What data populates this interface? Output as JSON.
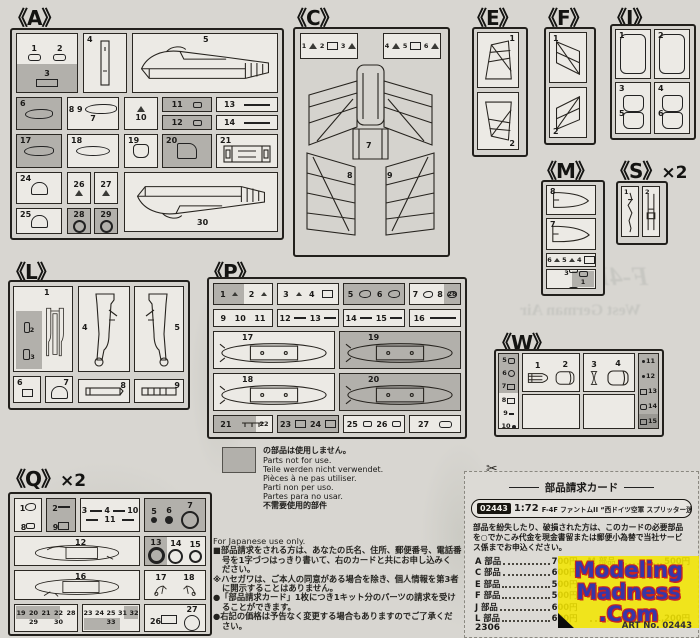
{
  "page": {
    "paper": "#d8d6d1",
    "box_bg": "#eceae5",
    "shaded": "#b2b0ab",
    "border": "#22201c"
  },
  "sprues": {
    "A": {
      "label": "《A》",
      "n": {
        "1": "1",
        "2": "2",
        "3": "3",
        "4": "4",
        "5": "5",
        "6": "6",
        "7": "7",
        "8": "8",
        "9": "9",
        "10": "10",
        "11": "11",
        "12": "12",
        "13": "13",
        "14": "14",
        "17": "17",
        "18": "18",
        "19": "19",
        "20": "20",
        "21": "21",
        "24": "24",
        "25": "25",
        "26": "26",
        "27": "27",
        "28": "28",
        "29": "29",
        "30": "30"
      }
    },
    "C": {
      "label": "《C》",
      "n": {
        "1": "1",
        "2": "2",
        "3": "3",
        "4": "4",
        "5": "5",
        "6": "6",
        "7": "7",
        "8": "8",
        "9": "9"
      }
    },
    "E": {
      "label": "《E》",
      "n": {
        "1": "1",
        "2": "2"
      }
    },
    "F": {
      "label": "《F》",
      "n": {
        "1": "1",
        "2": "2"
      }
    },
    "J": {
      "label": "《J》",
      "n": {
        "1": "1",
        "2": "2",
        "3": "3",
        "4": "4",
        "5": "5",
        "6": "6"
      }
    },
    "M": {
      "label": "《M》",
      "n": {
        "1": "1",
        "2": "2",
        "3": "3",
        "4": "4",
        "5": "5",
        "6": "6",
        "7": "7",
        "8": "8"
      }
    },
    "S": {
      "label": "《S》",
      "mult": "×2",
      "n": {
        "1": "1",
        "2": "2"
      }
    },
    "W": {
      "label": "《W》",
      "n": {
        "1": "1",
        "2": "2",
        "3": "3",
        "4": "4",
        "5": "5",
        "6": "6",
        "7": "7",
        "8": "8",
        "9": "9",
        "10": "10",
        "11": "11",
        "12": "12",
        "13": "13",
        "14": "14",
        "15": "15"
      }
    },
    "L": {
      "label": "《L》",
      "n": {
        "1": "1",
        "2": "2",
        "3": "3",
        "4": "4",
        "5": "5",
        "6": "6",
        "7": "7",
        "8": "8",
        "9": "9"
      }
    },
    "P": {
      "label": "《P》",
      "n": {
        "1": "1",
        "2": "2",
        "3": "3",
        "4": "4",
        "5": "5",
        "6": "6",
        "7": "7",
        "8": "8",
        "9": "9",
        "10": "10",
        "11": "11",
        "12": "12",
        "13": "13",
        "14": "14",
        "15": "15",
        "16": "16",
        "17": "17",
        "18": "18",
        "19": "19",
        "20": "20",
        "21": "21",
        "22": "22",
        "23": "23",
        "24": "24",
        "25": "25",
        "26": "26",
        "27": "27",
        "28": "28"
      }
    },
    "Q": {
      "label": "《Q》",
      "mult": "×2",
      "n": {
        "1": "1",
        "2": "2",
        "3": "3",
        "4": "4",
        "5": "5",
        "6": "6",
        "7": "7",
        "8": "8",
        "9": "9",
        "10": "10",
        "11": "11",
        "12": "12",
        "13": "13",
        "14": "14",
        "15": "15",
        "16": "16",
        "17": "17",
        "18": "18",
        "19": "19",
        "20": "20",
        "21": "21",
        "22": "22",
        "23": "23",
        "24": "24",
        "25": "25",
        "26": "26",
        "27": "27",
        "28": "28",
        "29": "29",
        "30": "30",
        "31": "31",
        "32": "32",
        "33": "33"
      }
    }
  },
  "notice": {
    "swatch_note": "の部品は使用しません。",
    "lines": [
      "Parts not for use.",
      "Teile werden nicht verwendet.",
      "Pièces à ne pas utiliser.",
      "Parti non per uso.",
      "Partes para no usar.",
      "不需要使用的部件"
    ]
  },
  "note": {
    "lines": [
      "For Japanese use only.",
      "■部品請求をされる方は、あなたの氏名、住所、郵便番号、電話番",
      "号を1字づつはっきり書いて、右のカードと共にお申し込みく",
      "ださい。",
      "※ハセガワは、ご本人の同意がある場合を除き、個人情報を第3者",
      "に開示することはありません。",
      "●「部品請求カード」1枚につき1キット分のパーツの請求を受け",
      "ることができます。",
      "●右記の価格は予告なく変更する場合もありますのでご了承くだ",
      "さい。"
    ]
  },
  "card": {
    "title": "部品請求カード",
    "kit_no": "02443",
    "scale": "1:72",
    "kit_name": "F-4F ファントムII “西ドイツ空軍 スプリッター迷彩”",
    "body": "部品を紛失したり、破損された方は、このカードの必要部品を○でかこみ代金を現金書留または郵便小為替で当社サービス係までお申込ください。",
    "prices_left": [
      {
        "label": "A 部品",
        "value": "700円"
      },
      {
        "label": "C 部品",
        "value": "600円"
      },
      {
        "label": "E 部品",
        "value": "500円"
      },
      {
        "label": "F 部品",
        "value": "500円"
      },
      {
        "label": "J 部品",
        "value": "600円"
      },
      {
        "label": "L 部品",
        "value": "600円"
      }
    ],
    "prices_right": [
      {
        "label": "M 部品",
        "value": "500円"
      },
      {
        "label": "",
        "value": ""
      },
      {
        "label": "",
        "value": ""
      },
      {
        "label": "",
        "value": ""
      },
      {
        "label": "",
        "value": ""
      },
      {
        "label": "",
        "value": "1,200円"
      }
    ],
    "footer_code": "2306",
    "art_no": "ART No. 02443"
  },
  "logo": {
    "line1": "Modeling",
    "line2": "Madness",
    "line3": ".Com",
    "bg": "#f3e502",
    "text_color": "#3737a8",
    "outline_color": "#c82323"
  },
  "bleedthrough": {
    "t1": "F-4F",
    "t2": "West German Air"
  }
}
